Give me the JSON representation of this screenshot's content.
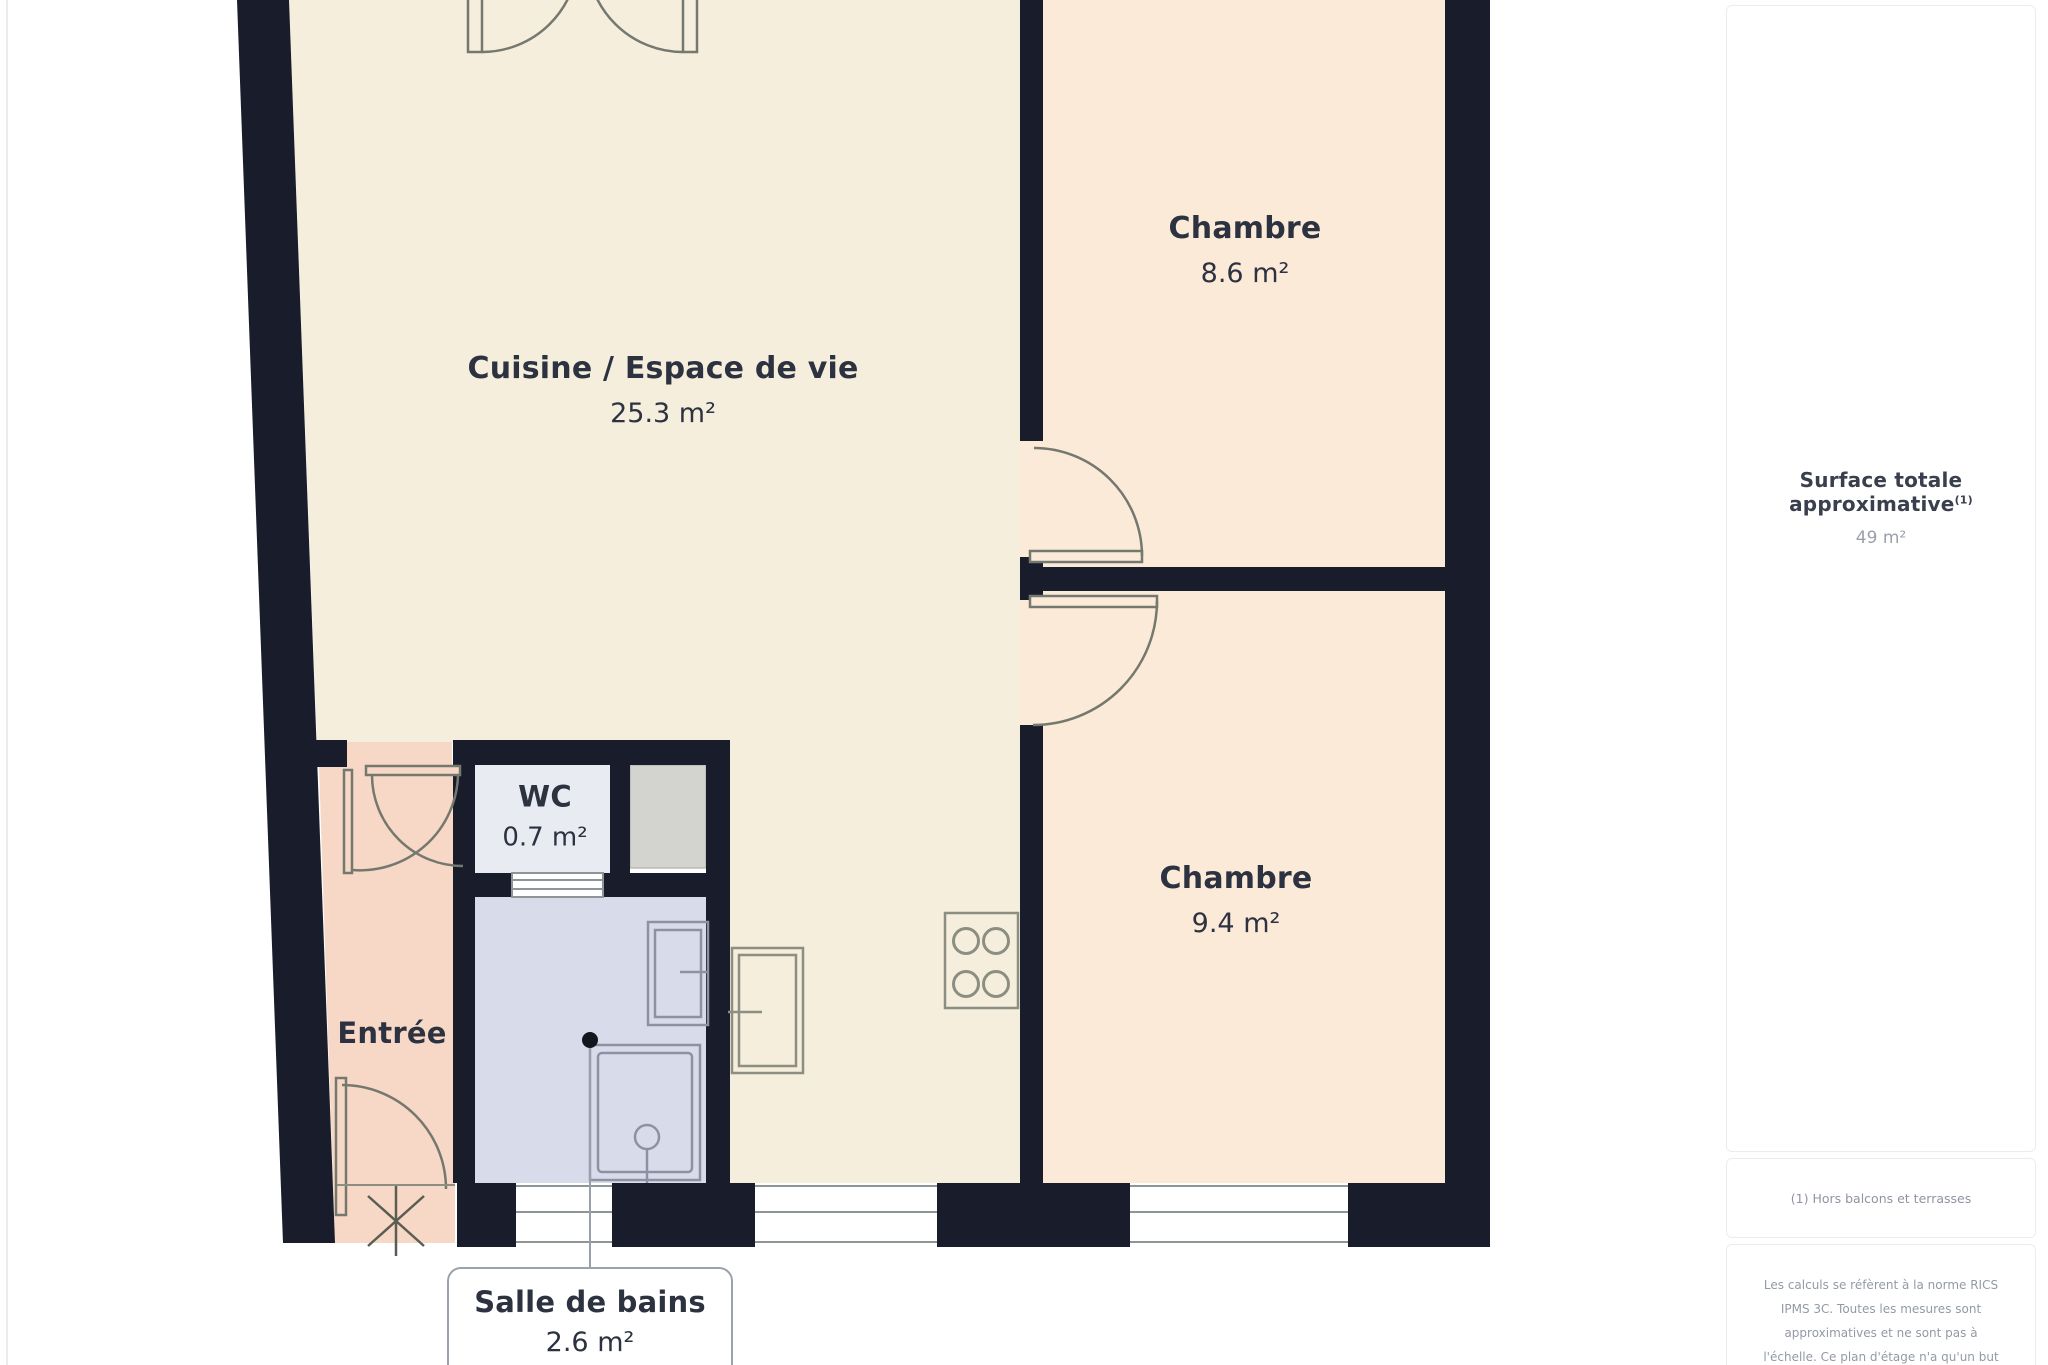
{
  "colors": {
    "wall": "#181c2b",
    "cuisine": "#f5eedd",
    "chambre": "#fcead9",
    "entree": "#f7d8c6",
    "salle_de_bains": "#d8dcea",
    "wc": "#e9ebf3",
    "shaft": "#d3d4cf"
  },
  "rooms": {
    "cuisine": {
      "name": "Cuisine / Espace de vie",
      "area": "25.3 m²"
    },
    "chambre_haut": {
      "name": "Chambre",
      "area": "8.6 m²"
    },
    "chambre_bas": {
      "name": "Chambre",
      "area": "9.4 m²"
    },
    "wc": {
      "name": "WC",
      "area": "0.7 m²"
    },
    "entree": {
      "name": "Entrée"
    },
    "salle_de_bains": {
      "name": "Salle de bains",
      "area": "2.6 m²"
    }
  },
  "sidebar": {
    "surface_title": "Surface totale approximative",
    "surface_note_marker": "(1)",
    "surface_value": "49 m²",
    "footnote": "(1) Hors balcons et terrasses",
    "disclaimer_lines": [
      "Les calculs se réfèrent à la norme RICS",
      "IPMS 3C. Toutes les mesures sont",
      "approximatives et ne sont pas à",
      "l'échelle. Ce plan d'étage n'a qu'un but"
    ]
  }
}
